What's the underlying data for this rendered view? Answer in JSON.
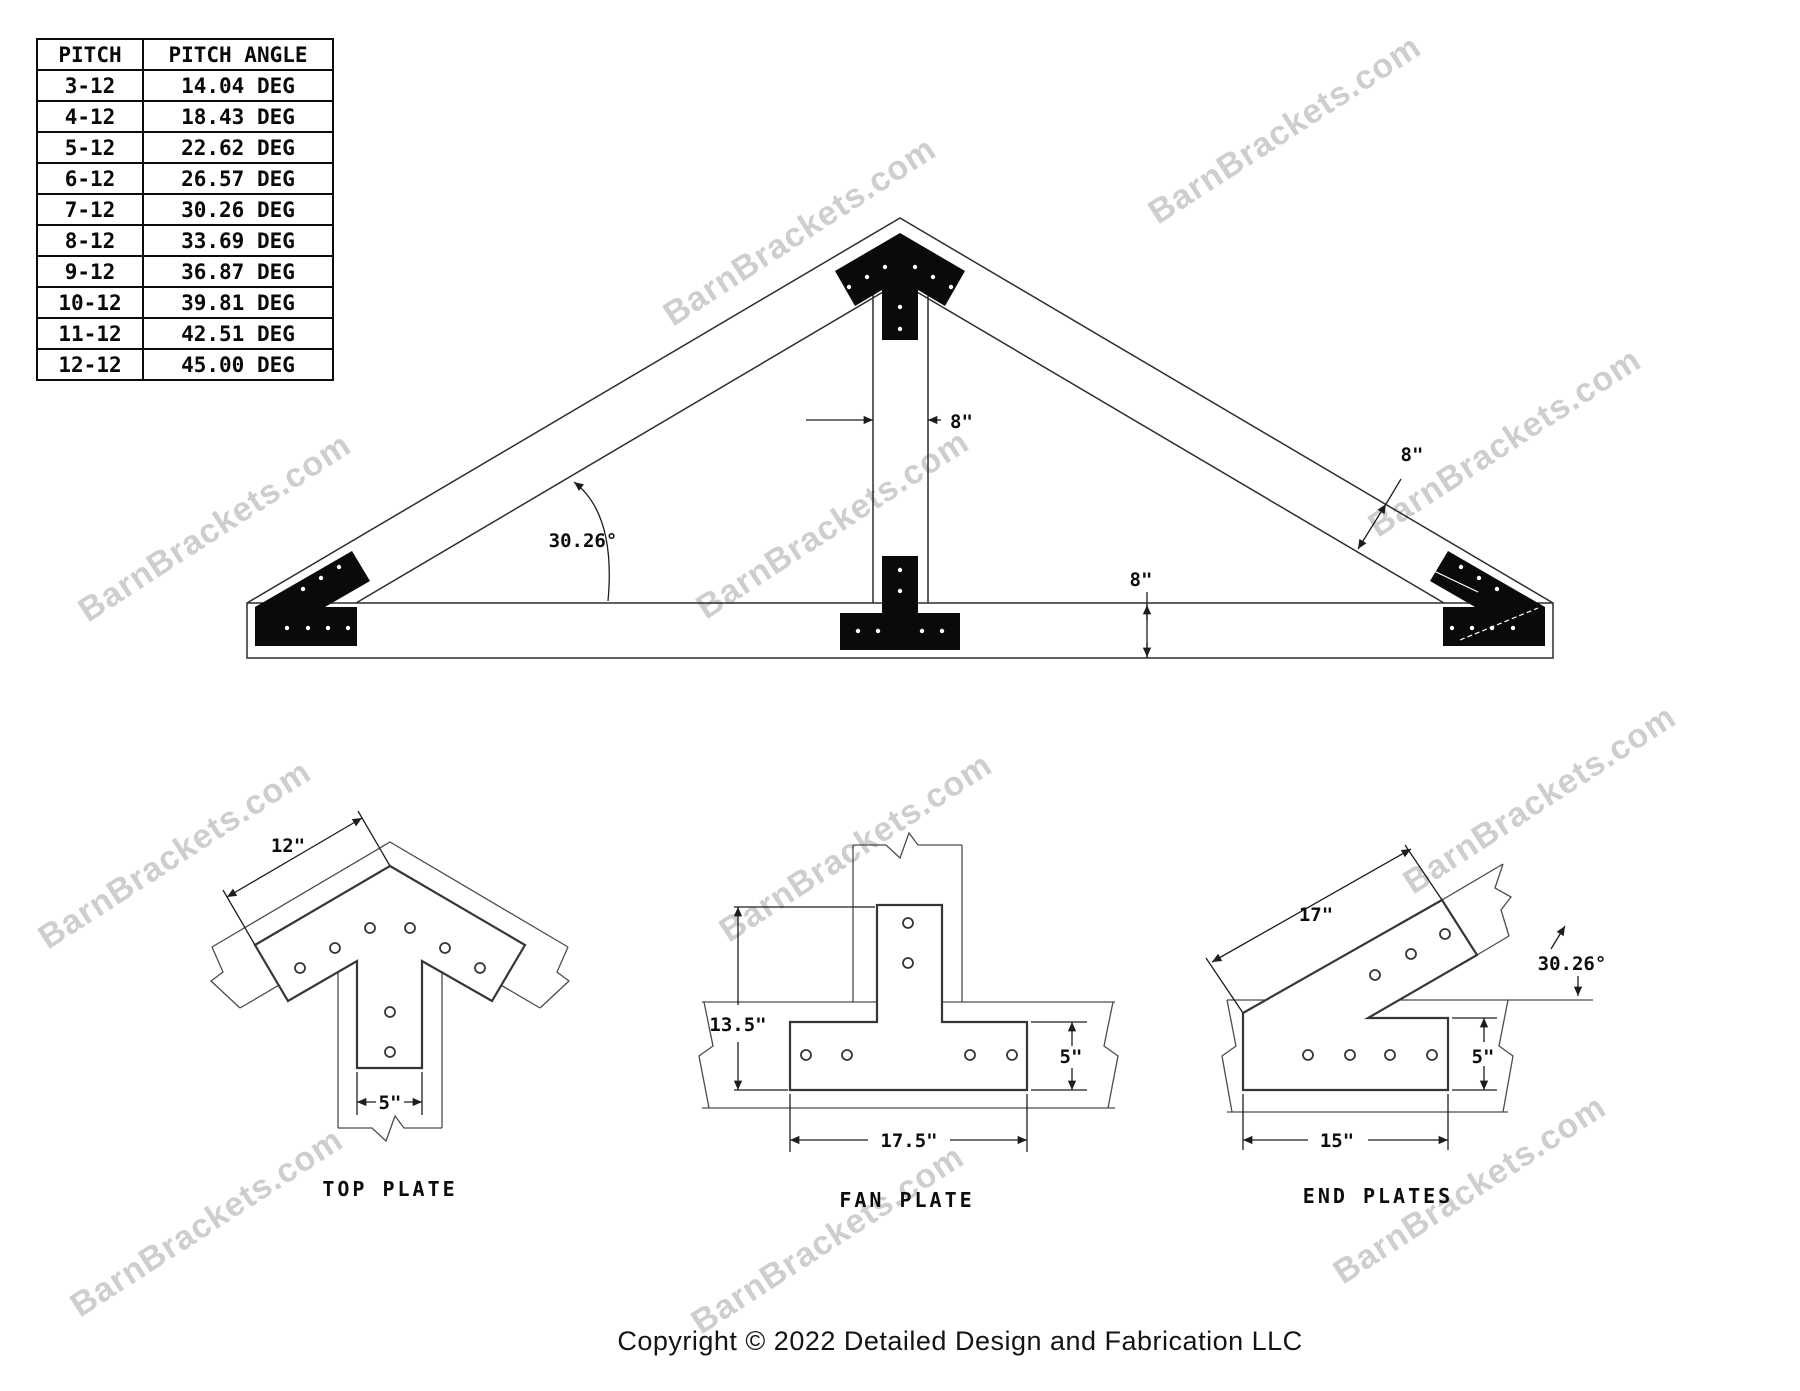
{
  "watermark": {
    "text": "BarnBrackets.com"
  },
  "pitch_table": {
    "headers": {
      "pitch": "PITCH",
      "angle": "PITCH ANGLE"
    },
    "rows": [
      {
        "pitch": "3-12",
        "angle": "14.04 DEG"
      },
      {
        "pitch": "4-12",
        "angle": "18.43 DEG"
      },
      {
        "pitch": "5-12",
        "angle": "22.62 DEG"
      },
      {
        "pitch": "6-12",
        "angle": "26.57 DEG"
      },
      {
        "pitch": "7-12",
        "angle": "30.26 DEG"
      },
      {
        "pitch": "8-12",
        "angle": "33.69 DEG"
      },
      {
        "pitch": "9-12",
        "angle": "36.87 DEG"
      },
      {
        "pitch": "10-12",
        "angle": "39.81 DEG"
      },
      {
        "pitch": "11-12",
        "angle": "42.51 DEG"
      },
      {
        "pitch": "12-12",
        "angle": "45.00 DEG"
      }
    ]
  },
  "truss": {
    "king_post_width": "8\"",
    "rafter_depth": "8\"",
    "chord_depth": "8\"",
    "pitch_angle": "30.26°"
  },
  "details": {
    "top_plate": {
      "title": "TOP PLATE",
      "edge_length": "12\"",
      "stem_width": "5\""
    },
    "fan_plate": {
      "title": "FAN PLATE",
      "height": "13.5\"",
      "bar_height": "5\"",
      "bar_length": "17.5\""
    },
    "end_plates": {
      "title": "END PLATES",
      "arm_length": "17\"",
      "angle": "30.26°",
      "bar_height": "5\"",
      "bar_length": "15\""
    }
  },
  "footer": {
    "copyright": "Copyright © 2022 Detailed Design and Fabrication LLC"
  }
}
